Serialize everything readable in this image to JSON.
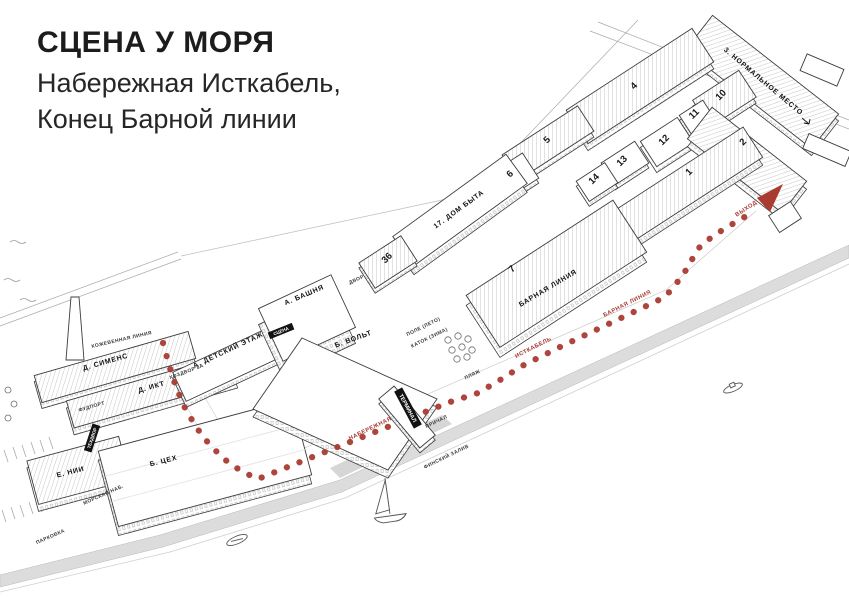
{
  "title": {
    "heading": "СЦЕНА У МОРЯ",
    "line2": "Набережная Исткабель,",
    "line3": "Конец Барной линии"
  },
  "colors": {
    "accent_red": "#a93b31",
    "ink": "#2a2a2a",
    "ground_gray": "#dcdcdc"
  },
  "map": {
    "numbered": [
      "4",
      "5",
      "10",
      "11",
      "12",
      "13",
      "14",
      "2",
      "1",
      "6",
      "7",
      "36"
    ],
    "buildings": {
      "dom_byta": "17. ДОМ БЫТА",
      "normalnoe_mesto": "3. НОРМАЛЬНОЕ МЕСТО",
      "barnaya_liniya_roof": "БАРНАЯ ЛИНИЯ",
      "siemens": "Д. СИМЕНС",
      "ikt": "Д. ИКТ",
      "detskiy_etazh": "А. ДЕТСКИЙ ЭТАЖ",
      "bashnya": "А. БАШНЯ",
      "volt": "Б. ВОЛЬТ",
      "tseh": "Б. ЦЕХ",
      "nii": "Е. НИИ",
      "terminal": "ТЕРМИНАЛ",
      "scena": "СЦЕНА",
      "tehdvor": "ТЕХДВОР"
    },
    "places": {
      "kozhevennaya_liniya": "КОЖЕВЕННАЯ ЛИНИЯ",
      "fudport": "ФУДПОРТ",
      "hozdvor": "ХОЗДВОР 8А",
      "morskaya_nab": "МОРСКАЯ НАБ.",
      "parkovka": "ПАРКОВКА",
      "dvor": "ДВОР",
      "pole_leto": "ПОЛЕ (ЛЕТО)",
      "katok_zima": "КАТОК (ЗИМА)",
      "plyazh": "ПЛЯЖ",
      "prichal": "ПРИЧАЛ",
      "finskiy_zaliv": "ФИНСКИЙ ЗАЛИВ"
    },
    "route": {
      "naberezhnaya": "НАБЕРЕЖНАЯ",
      "istkabel": "ИСТКАБЕЛЬ",
      "barnaya_liniya": "БАРНАЯ ЛИНИЯ",
      "vyhod": "ВЫХОД"
    }
  }
}
